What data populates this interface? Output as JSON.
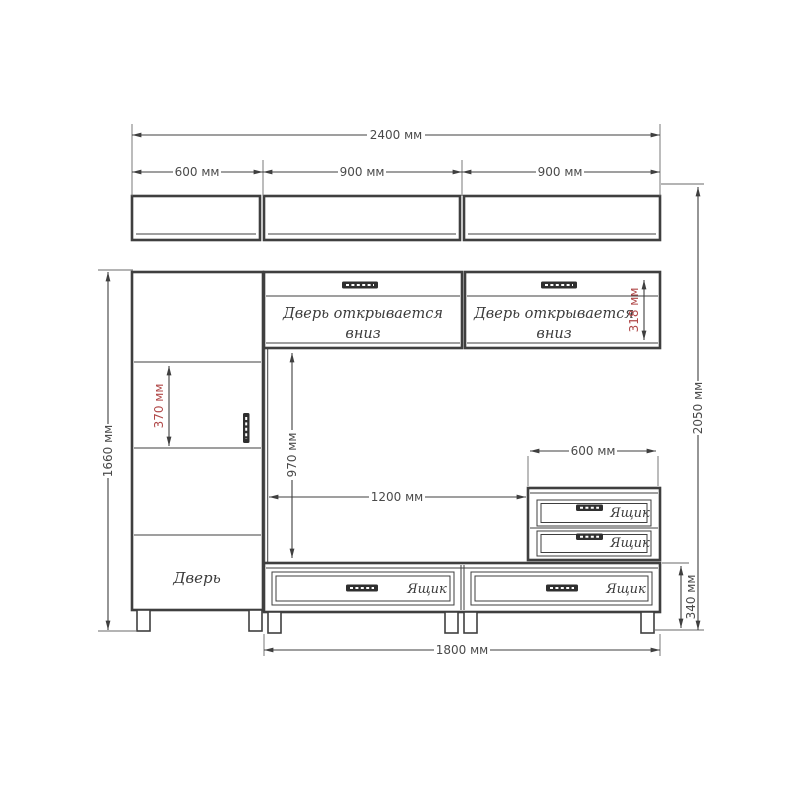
{
  "colors": {
    "line": "#3f3f3f",
    "dimtext": "#4a4a4a",
    "red": "#b04848",
    "bg": "#ffffff"
  },
  "labels": {
    "flap_door_line1": "Дверь открывается",
    "flap_door_line2": "вниз",
    "door": "Дверь",
    "drawer": "Ящик"
  },
  "dimensions": {
    "total_width": "2400 мм",
    "shelf_left_width": "600 мм",
    "shelf_center_width": "900 мм",
    "shelf_right_width": "900 мм",
    "cabinet_height": "1660 мм",
    "overall_height": "2050 мм",
    "shelf_section_height": "370 мм",
    "flap_height": "318 мм",
    "niche_height": "970 мм",
    "niche_width": "1200 мм",
    "drawer_unit_width": "600 мм",
    "drawer_row_height": "340 мм",
    "base_width": "1800 мм"
  }
}
